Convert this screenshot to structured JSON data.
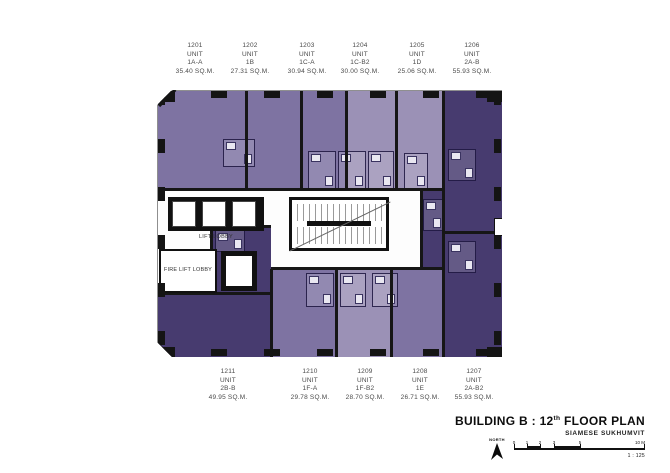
{
  "colors": {
    "unit_light": "#9b91b6",
    "unit_medium": "#7e73a2",
    "unit_dark": "#473b6f",
    "wall": "#161616"
  },
  "core": {
    "lift_lobby_label": "LIFT LOBBY",
    "fire_lift_lobby_label": "FIRE LIFT LOBBY"
  },
  "units": {
    "top": [
      {
        "number": "1201",
        "unit_word": "UNIT",
        "type": "1A-A",
        "area": "35.40 SQ.M.",
        "color": "#7e73a2"
      },
      {
        "number": "1202",
        "unit_word": "UNIT",
        "type": "1B",
        "area": "27.31 SQ.M.",
        "color": "#7e73a2"
      },
      {
        "number": "1203",
        "unit_word": "UNIT",
        "type": "1C-A",
        "area": "30.94 SQ.M.",
        "color": "#7e73a2"
      },
      {
        "number": "1204",
        "unit_word": "UNIT",
        "type": "1C-B2",
        "area": "30.00 SQ.M.",
        "color": "#9b91b6"
      },
      {
        "number": "1205",
        "unit_word": "UNIT",
        "type": "1D",
        "area": "25.06 SQ.M.",
        "color": "#9b91b6"
      },
      {
        "number": "1206",
        "unit_word": "UNIT",
        "type": "2A-B",
        "area": "55.93 SQ.M.",
        "color": "#473b6f"
      }
    ],
    "bottom": [
      {
        "number": "1211",
        "unit_word": "UNIT",
        "type": "2B-B",
        "area": "49.95 SQ.M.",
        "color": "#473b6f"
      },
      {
        "number": "1210",
        "unit_word": "UNIT",
        "type": "1F-A",
        "area": "29.78 SQ.M.",
        "color": "#7e73a2"
      },
      {
        "number": "1209",
        "unit_word": "UNIT",
        "type": "1F-B2",
        "area": "28.70 SQ.M.",
        "color": "#9b91b6"
      },
      {
        "number": "1208",
        "unit_word": "UNIT",
        "type": "1E",
        "area": "26.71 SQ.M.",
        "color": "#7e73a2"
      },
      {
        "number": "1207",
        "unit_word": "UNIT",
        "type": "2A-B2",
        "area": "55.93 SQ.M.",
        "color": "#473b6f"
      }
    ]
  },
  "title_block": {
    "title_prefix": "BUILDING B : 12",
    "title_super": "th",
    "title_suffix": " FLOOR PLAN",
    "subtitle": "SIAMESE SUKHUMVIT",
    "north_label": "NORTH",
    "scale_ticks": [
      "0",
      "1",
      "2",
      "3",
      "5"
    ],
    "scale_end_label": "10 M",
    "scale_ratio": "1 : 125"
  }
}
